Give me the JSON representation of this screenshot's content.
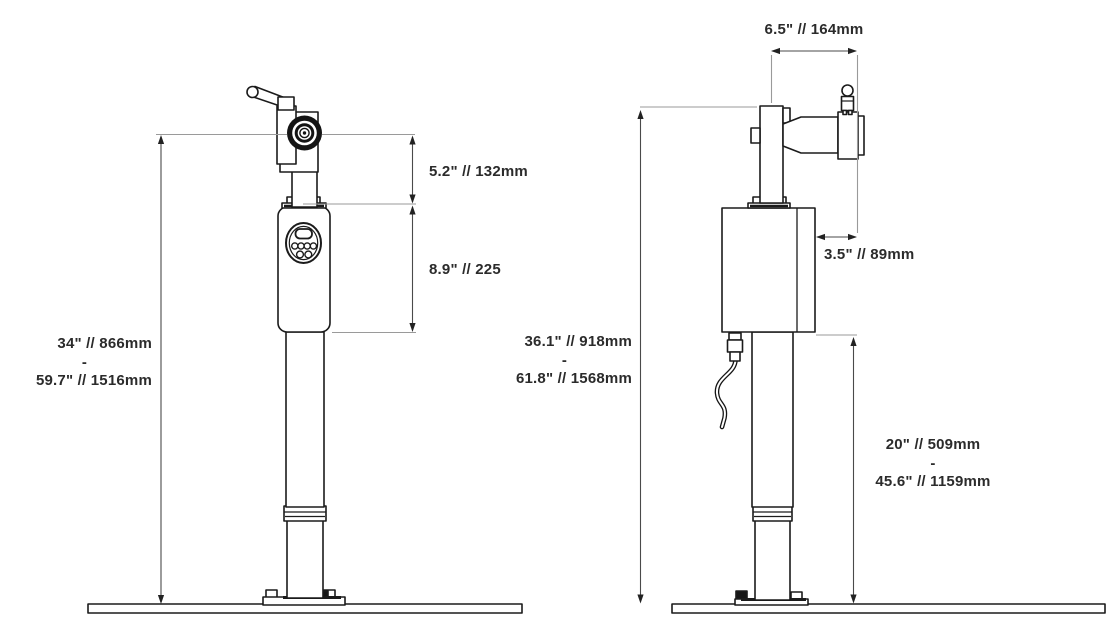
{
  "drawing": {
    "type": "technical-dimension-drawing",
    "colors": {
      "line": "#1b1b1b",
      "extension_line": "#9a9a9a",
      "dimension_line": "#4a4a4a",
      "text": "#2b2b2b",
      "background": "#ffffff"
    },
    "views": {
      "front": {
        "overall_height": {
          "min": "34\" // 866mm",
          "separator": "-",
          "max": "59.7\" // 1516mm"
        },
        "head_height": "5.2\" // 132mm",
        "control_body_height": "8.9\" // 225"
      },
      "side": {
        "arm_reach": "6.5\" // 164mm",
        "arm_offset": "3.5\" // 89mm",
        "overall_height": {
          "min": "36.1\" // 918mm",
          "separator": "-",
          "max": "61.8\" // 1568mm"
        },
        "column_height": {
          "min": "20\" // 509mm",
          "separator": "-",
          "max": "45.6\" // 1159mm"
        }
      }
    }
  }
}
